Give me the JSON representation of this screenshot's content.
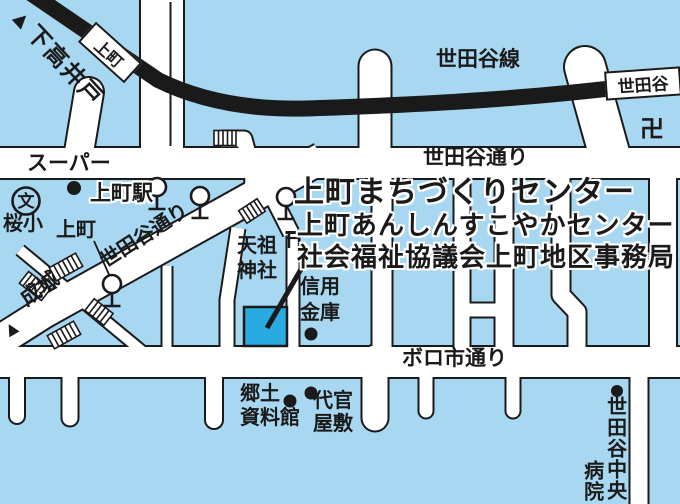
{
  "colors": {
    "background": "#A8D8F1",
    "road": "#FFFFFF",
    "line": "#1A1A1A",
    "highlight_building": "#29ABE2"
  },
  "railway": {
    "line_label": "世田谷線",
    "direction_label": "▲下高井戸",
    "stations": [
      {
        "name": "上町"
      },
      {
        "name": "世田谷"
      }
    ]
  },
  "roads": {
    "setagaya_dori": "世田谷通り",
    "setagaya_dori_diagonal": "世田谷通り",
    "boroichi_dori": "ボロ市通り",
    "seijo": "成城",
    "seijo_arrow": "▲"
  },
  "destination": {
    "line1": "上町まちづくりセンター",
    "line2": "上町あんしんすこやかセンター",
    "line3": "社会福祉協議会上町地区事務局"
  },
  "places": {
    "supermarket": "スーパー",
    "kamimachi_station": "上町駅",
    "school_symbol": "文",
    "sakura_elementary": "桜小",
    "kamimachi_crossing": "上町",
    "tenso_shrine": "天祖\n神社",
    "shinkin_bank": "信用\n金庫",
    "kyodo_museum": "郷土\n資料館",
    "daikan_yashiki": "代官\n屋敷",
    "hospital_main": "世田谷中央",
    "hospital_sub": "病院",
    "temple_symbol": "卍"
  }
}
